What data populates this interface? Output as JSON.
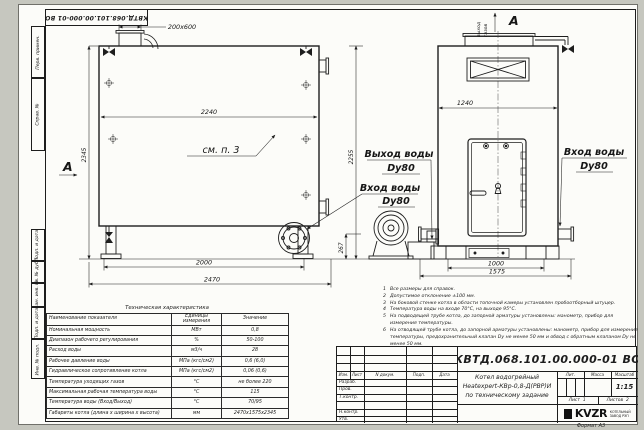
{
  "watermark": "kotel-kvr.ru",
  "stamp_top": "КВТД.068.101.00.000-01 ВО",
  "frame": {
    "top_labels": [
      "Перв. примен.",
      "Справ. №"
    ],
    "bottom_labels": [
      "Подп. и дата",
      "Инв. № дубл.",
      "Взам. инв. №",
      "Подп. и дата",
      "Инв. № подл."
    ],
    "format_note": "Формат А3"
  },
  "drawing": {
    "view_marker": "А",
    "see_note": "см. п. 3",
    "gas_out_line1": "выход",
    "gas_out_line2": "газов",
    "water_out_label": "Выход воды",
    "water_in_label": "Вход воды",
    "dn_label": "Dу80",
    "dims": {
      "chimney": "200х600",
      "body_length": "2240",
      "height_total": "2345",
      "legs_span": "2000",
      "overall_length": "2470",
      "front_height": "2255",
      "burner_axis": "267",
      "front_width": "1240",
      "front_legs_span": "1000",
      "overall_width": "1575"
    }
  },
  "notes": {
    "items": [
      {
        "n": "1",
        "text": "Все размеры для справок."
      },
      {
        "n": "2",
        "text": "Допустимое отклонение ±100 мм."
      },
      {
        "n": "3",
        "text": "На боковой стенке котла в области топочной камеры установлен пробоотборный штуцер."
      },
      {
        "n": "4",
        "text": "Температура воды на входе 70°С, на выходе 95°С."
      },
      {
        "n": "5",
        "text": "На подводящей трубе котла, до запорной арматуры установлены: манометр, прибор для измерения температуры."
      },
      {
        "n": "6",
        "text": "На отводящей трубе котла, до запорной арматуры установлены: манометр, прибор для измерения температуры, предохранительный клапан Dу не менее 50 мм и обвод с обратным клапаном Dу не менее 50 мм."
      },
      {
        "n": "7",
        "text": "Остальные технические требования по ОСТ 108.030.133-84."
      }
    ]
  },
  "spec": {
    "title": "Техническая характеристика",
    "col_name": "Наименование показателя",
    "col_units": "Единицы измерения",
    "col_value": "Значение",
    "rows": [
      {
        "name": "Номинальная мощность",
        "units": "МВт",
        "value": "0,8"
      },
      {
        "name": "Диапазон рабочего регулирования",
        "units": "%",
        "value": "50-100"
      },
      {
        "name": "Расход воды",
        "units": "м3/ч",
        "value": "28"
      },
      {
        "name": "Рабочее давление воды",
        "units": "МПа (кгс/см2)",
        "value": "0,6 (6,0)"
      },
      {
        "name": "Гидравлическое сопротивление котла",
        "units": "МПа (кгс/см2)",
        "value": "0,06 (0,6)"
      },
      {
        "name": "Температура уходящих газов",
        "units": "°С",
        "value": "не более 220"
      },
      {
        "name": "Максимальная рабочая температура воды",
        "units": "°С",
        "value": "115"
      },
      {
        "name": "Температура воды (Вход/Выход)",
        "units": "°С",
        "value": "70/95"
      },
      {
        "name": "Габариты котла (длина х ширина х высота)",
        "units": "мм",
        "value": "2470х1575х2345"
      }
    ]
  },
  "title_block": {
    "doc_number": "КВТД.068.101.00.000-01  ВО",
    "name1": "Котел водогрейный",
    "name2": "Heatexpert-КВр-0,8-Д(РВР)И",
    "name3": "по техническому задание",
    "col_izm": "Изм.",
    "col_list": "Лист",
    "col_ndoc": "N докум.",
    "col_podp": "Подп.",
    "col_data": "Дата",
    "sig_rows": [
      "Разраб.",
      "Пров.",
      "Т.контр.",
      "",
      "Н.контр.",
      "Утв."
    ],
    "lit": "Лит.",
    "massa": "Масса",
    "masshtab": "Масштаб",
    "scale": "1:15",
    "list_label": "Лист",
    "list_val": "1",
    "listov_label": "Листов",
    "listov_val": "2",
    "logo": "KVZR",
    "logo_line1": "КОТЕЛЬНЫЙ",
    "logo_line2": "ЗАВОД РЭП"
  }
}
